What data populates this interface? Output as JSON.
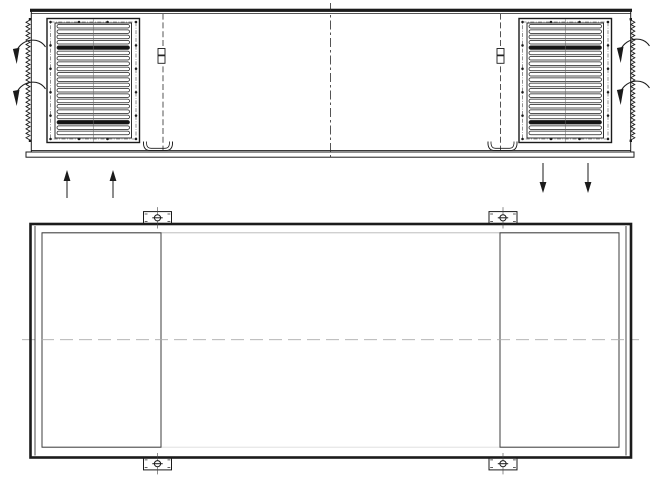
{
  "drawing_title": "hvac-unit-two-view-technical-drawing",
  "canvas": {
    "w": 660,
    "h": 483,
    "bg": "#ffffff",
    "ink": "#1b1b1b"
  },
  "front_view": {
    "label": "front-elevation-view",
    "cap": {
      "x1": 30,
      "x2": 632,
      "y": 8.7,
      "t": 3.2,
      "under_y": 13.6
    },
    "body": {
      "left_x": 31.3,
      "right_x": 630.7,
      "top_y": 10,
      "bottom_y": 150.4
    },
    "rail": {
      "x": 26,
      "y": 152,
      "w": 608,
      "h": 5.2
    },
    "centerline": {
      "x": 330.5,
      "y1": 3,
      "y2": 158,
      "dash": "9 3 2.5 3",
      "color": "#2a2a2a"
    },
    "door_lines": [
      {
        "x": 163,
        "y1": 13.6,
        "y2": 150
      },
      {
        "x": 500.5,
        "y1": 13.6,
        "y2": 150
      }
    ],
    "hinges": [
      {
        "cx": 161.5,
        "y": 48.5
      },
      {
        "cx": 500.5,
        "y": 48.5
      }
    ],
    "channel": {
      "y_top": 141.5,
      "half_w": 14.5,
      "depth": 9
    },
    "channels": [
      {
        "cx": 158
      },
      {
        "cx": 502.5
      }
    ],
    "vents": [
      {
        "side": "left",
        "x": 47,
        "y": 18.5,
        "w": 92.5,
        "h": 124,
        "louvers": 21,
        "dark": [
          4,
          18
        ]
      },
      {
        "side": "right",
        "x": 519,
        "y": 18.5,
        "w": 92.5,
        "h": 124,
        "louvers": 21,
        "dark": [
          4,
          18
        ]
      }
    ],
    "zigzags": [
      {
        "side": "left",
        "x": 30,
        "y1": 20,
        "y2": 140,
        "teeth": 27,
        "amp": 4,
        "dir": -1
      },
      {
        "side": "right",
        "x": 630.8,
        "y1": 20,
        "y2": 140,
        "teeth": 27,
        "amp": 4,
        "dir": 1
      }
    ],
    "curl_arrows": [
      {
        "hx": 15.5,
        "hy": 52
      },
      {
        "hx": 15.5,
        "hy": 94
      },
      {
        "hx": 619.5,
        "hy": 51
      },
      {
        "hx": 619.5,
        "hy": 93
      }
    ],
    "flow_arrows": [
      {
        "x": 67,
        "tail_y": 198,
        "tip_y": 170,
        "dir": "up"
      },
      {
        "x": 113,
        "tail_y": 198,
        "tip_y": 170,
        "dir": "up"
      },
      {
        "x": 543,
        "tail_y": 163,
        "tip_y": 193,
        "dir": "down"
      },
      {
        "x": 588,
        "tail_y": 163,
        "tip_y": 193,
        "dir": "down"
      }
    ]
  },
  "plan_view": {
    "label": "bottom-plan-view",
    "outer": {
      "x": 30.5,
      "y": 224,
      "w": 600.5,
      "h": 233.5,
      "stroke_w": 2.6
    },
    "wall_lines": [
      {
        "x": 35
      },
      {
        "x": 626
      }
    ],
    "inner_lines": [
      {
        "y": 232.8,
        "x1": 42,
        "x2": 619,
        "color": "#b5b5b5"
      },
      {
        "y": 447.2,
        "x1": 42,
        "x2": 619,
        "color": "#dcdcdc"
      }
    ],
    "panels": [
      {
        "side": "left",
        "x": 42,
        "y": 232.8,
        "w": 119,
        "h": 214.4
      },
      {
        "side": "right",
        "x": 500,
        "y": 232.8,
        "w": 119,
        "h": 214.4
      }
    ],
    "centerline": {
      "y": 339.7,
      "x1": 22,
      "x2": 639,
      "dash": "13 6",
      "color": "#ababab"
    },
    "bracket": {
      "w": 28,
      "h": 12.4
    },
    "brackets": [
      {
        "cx": 157.5,
        "edge": "top"
      },
      {
        "cx": 503,
        "edge": "top"
      },
      {
        "cx": 157.5,
        "edge": "bottom"
      },
      {
        "cx": 503,
        "edge": "bottom"
      }
    ]
  }
}
